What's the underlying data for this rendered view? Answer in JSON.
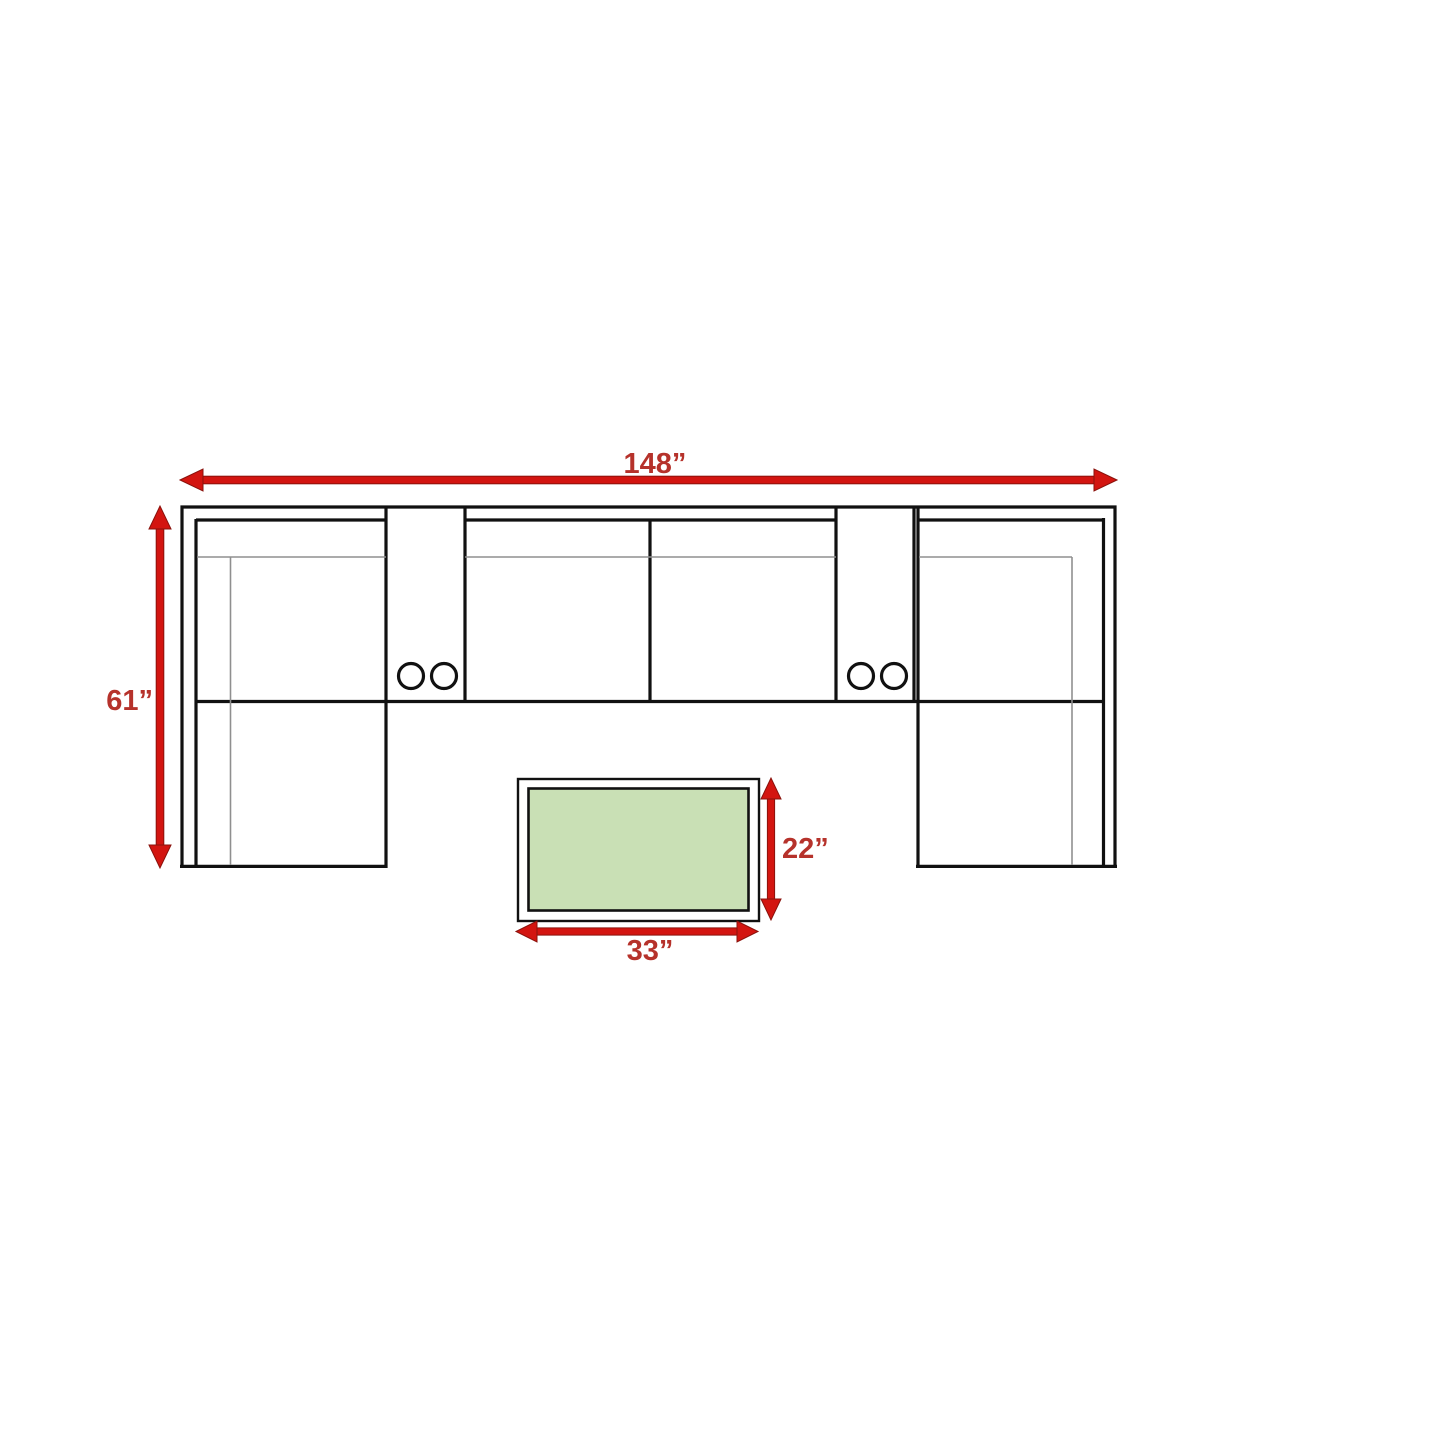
{
  "diagram": {
    "title": "sectional-sofa-with-table-dimension-diagram",
    "labels": {
      "sofa_width": "148”",
      "sofa_depth": "61”",
      "table_depth": "22”",
      "table_width": "33”"
    },
    "dimensions": [
      {
        "label": "148”",
        "measures": "sofa-overall-width",
        "orientation": "horizontal"
      },
      {
        "label": "61”",
        "measures": "sofa-overall-depth",
        "orientation": "vertical"
      },
      {
        "label": "22”",
        "measures": "coffee-table-depth",
        "orientation": "vertical"
      },
      {
        "label": "33”",
        "measures": "coffee-table-width",
        "orientation": "horizontal"
      }
    ],
    "components": {
      "sofa_sections": [
        "left-chaise",
        "left-console-with-2-cup-holders",
        "armless-seat-left",
        "armless-seat-right",
        "right-console-with-2-cup-holders",
        "right-chaise"
      ],
      "coffee_table": "rectangular-table-green-top"
    },
    "colors": {
      "arrow_red": "#D31510",
      "arrow_edge_red": "#8A120C",
      "label_red": "#B6322B",
      "table_green": "#C9E0B5",
      "outline_black": "#111111",
      "detail_gray": "#8F8F8F",
      "background": "#FFFFFF"
    }
  }
}
